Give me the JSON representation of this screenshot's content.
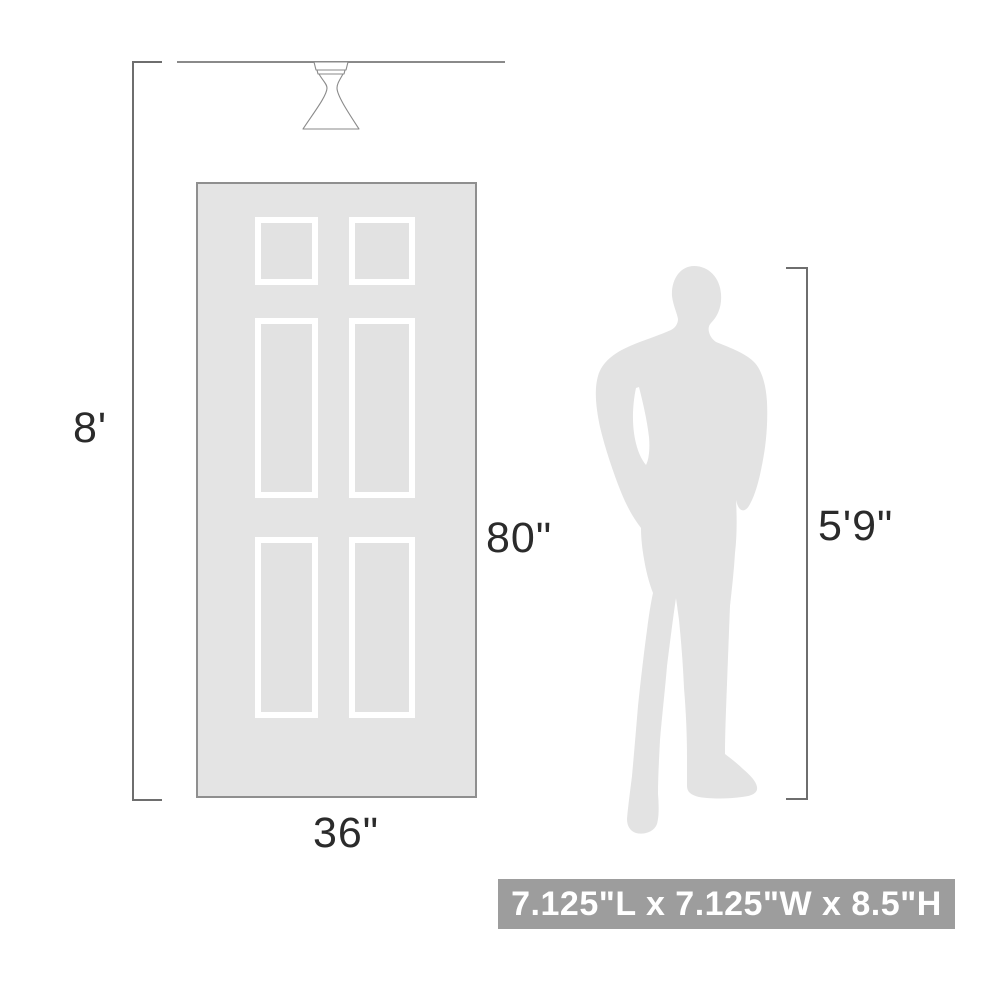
{
  "scene": {
    "wall_height_label": "8'",
    "door_height_label": "80\"",
    "door_width_label": "36\"",
    "person_height_label": "5'9\"",
    "fixture_size_label": "7.125\"L x 7.125\"W x 8.5\"H"
  },
  "icons": {
    "fixture": "flush-mount-ceiling-light-icon",
    "door": "six-panel-door-illustration",
    "person": "male-person-silhouette"
  },
  "colors": {
    "background": "#ffffff",
    "line": "#8a8a8a",
    "dimension_line": "#6e6e6e",
    "text": "#2b2b2b",
    "door_fill": "#e4e4e4",
    "door_border": "#8f8f8f",
    "panel_frame": "#ffffff",
    "panel_fill": "#e2e2e2",
    "silhouette": "#e3e3e3",
    "banner_bg": "#9d9d9d",
    "banner_text": "#ffffff",
    "fixture_stroke": "#8a8a8a",
    "fixture_fill": "#ffffff"
  }
}
